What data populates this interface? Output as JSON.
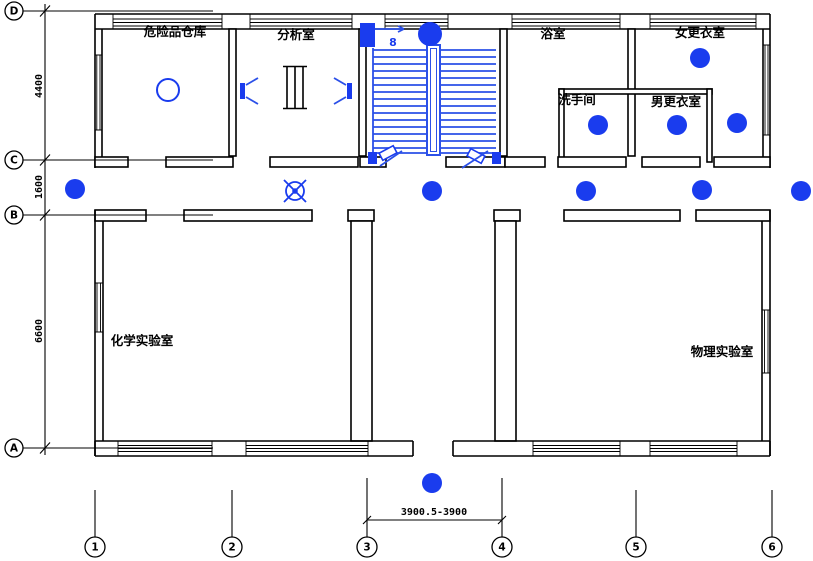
{
  "drawing_kind": "architectural-lighting-floor-plan",
  "colors": {
    "line": "#000000",
    "accent_blue": "#1a3cee",
    "stair_blue": "#2b50e8",
    "background": "#ffffff"
  },
  "rooms": [
    {
      "id": "hazard-storage",
      "label": "危险品仓库"
    },
    {
      "id": "analysis-room",
      "label": "分析室"
    },
    {
      "id": "bathroom",
      "label": "浴室"
    },
    {
      "id": "women-locker",
      "label": "女更衣室"
    },
    {
      "id": "washroom",
      "label": "洗手间"
    },
    {
      "id": "men-locker",
      "label": "男更衣室"
    },
    {
      "id": "chemistry-lab",
      "label": "化学实验室"
    },
    {
      "id": "physics-lab",
      "label": "物理实验室"
    }
  ],
  "axis_rows": [
    {
      "label": "D"
    },
    {
      "label": "C"
    },
    {
      "label": "B"
    },
    {
      "label": "A"
    }
  ],
  "axis_cols": [
    {
      "label": "1"
    },
    {
      "label": "2"
    },
    {
      "label": "3"
    },
    {
      "label": "4"
    },
    {
      "label": "5"
    },
    {
      "label": "6"
    }
  ],
  "dims": {
    "d_to_c": "4400",
    "c_to_b": "1600",
    "b_to_a": "6600",
    "axis3_to_axis4": "3900.5-3900"
  },
  "labels": {
    "panel": "8"
  },
  "symbols": [
    {
      "name": "ceiling-lamp-dot",
      "meaning": "filled round luminaire"
    },
    {
      "name": "pendant-lamp-circle",
      "meaning": "outline round luminaire"
    },
    {
      "name": "fan-lamp",
      "meaning": "circle with cross luminaire"
    },
    {
      "name": "wall-sconce",
      "meaning": "wall mounted light"
    },
    {
      "name": "distribution-box",
      "meaning": "lighting distribution panel"
    },
    {
      "name": "stairs",
      "meaning": "staircase with handrail"
    }
  ]
}
